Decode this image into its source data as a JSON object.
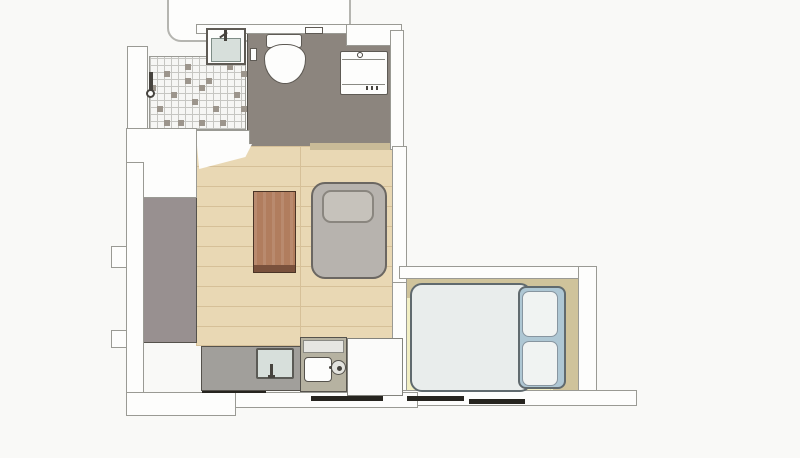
{
  "title": "studio-apartment-floor-plan",
  "canvas": {
    "width": 800,
    "height": 458
  },
  "rooms": [
    {
      "id": "bathroom",
      "floor": "dark-gray"
    },
    {
      "id": "shower",
      "floor": "checkered-tile"
    },
    {
      "id": "living-room",
      "floor": "wood-plank"
    },
    {
      "id": "hallway",
      "floor": "gray"
    },
    {
      "id": "bedroom",
      "floor": "pale-yellow",
      "closet_band": "khaki"
    },
    {
      "id": "kitchen",
      "floor": "wood-plank"
    }
  ],
  "fixtures": [
    "shower-valve",
    "vanity-sink",
    "toilet",
    "toilet-paper-holder",
    "bathroom-shelf",
    "washing-machine",
    "entry-door",
    "coffee-table",
    "sofa-bed",
    "double-bed",
    "bed-pillows",
    "kitchen-counter",
    "kitchen-sink",
    "kitchenette",
    "cooktop-burner",
    "appliance-unit",
    "window-bars",
    "neighbor-balcony"
  ],
  "window_bar_count": 4,
  "palette": {
    "background": "#f9f9f7",
    "wall_fill": "#fdfdfc",
    "wall_outline": "#9a9a94",
    "balcony_outline": "#b5b5b0",
    "outline_dark": "#55524c",
    "bathroom_floor": "#8c857e",
    "tile_base": "#f6f6f4",
    "tile_grout": "#c6c6c2",
    "tile_dark": "#9c958c",
    "wood_floor": "#e9d8b4",
    "wood_line": "#d6c098",
    "hall_floor": "#989090",
    "threshold": "#c9bb98",
    "table_wood": "#b17d5e",
    "table_edge": "#7a513c",
    "table_outline": "#4a3426",
    "sofa_fill": "#b7b3ae",
    "sofa_outline": "#6b6762",
    "sofa_pillow": "#c6c2bb",
    "pillow_outline": "#8a867f",
    "bedroom_floor": "#f2efc4",
    "grid_line_faint": "#e0dcae",
    "closet_band": "#cfc39b",
    "bed_duvet": "#e9edec",
    "bed_outline": "#606a6e",
    "bed_headboard": "#aec7d4",
    "bed_pillow": "#f0f3f2",
    "bed_pillow_outline": "#8795a0",
    "counter_fill": "#a19f9b",
    "sink_fill": "#d7dfdb",
    "sink_outline": "#5b5b56",
    "kitchenette_fill": "#b6b2a1",
    "appliance_white": "#fbfbfa",
    "appliance_outline": "#83837d",
    "fixture_white": "#fdfdfc",
    "fixture_outline": "#5e5a54",
    "metal_dark": "#46433e",
    "window_bar": "#26241f"
  }
}
